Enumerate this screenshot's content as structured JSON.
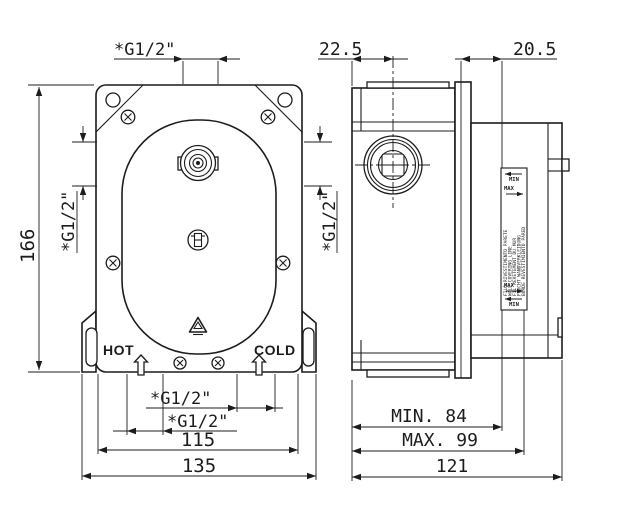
{
  "colors": {
    "line": "#1c1c1c",
    "background": "#ffffff"
  },
  "icons": {
    "hot_flow_arrow": "outline-up-arrow",
    "cold_flow_arrow": "outline-up-arrow",
    "brand_mark": "triangle",
    "fastener": "phillips-screw"
  },
  "front_view": {
    "top_port_label": "*G1/2\"",
    "left_port_label": "*G1/2\"",
    "right_port_label": "*G1/2\"",
    "height_dim": "166",
    "hot_label": "HOT",
    "cold_label": "COLD",
    "bottom_port_label_1": "*G1/2\"",
    "bottom_port_label_2": "*G1/2\"",
    "inner_width_dim": "115",
    "outer_width_dim": "135"
  },
  "side_view": {
    "top_offset_dim": "22.5",
    "plate_depth_dim": "20.5",
    "min_depth_dim": "MIN. 84",
    "max_depth_dim": "MAX. 99",
    "total_depth_dim": "121",
    "label_plate": {
      "top_min": "MIN",
      "top_max": "MAX",
      "bottom_max": "MAX",
      "bottom_min": "MIN",
      "lines": [
        "FILO RIVESTIMENTO PARETE",
        "WALL COVERING LINE",
        "FIL REVETEMENT DU MUR",
        "FLUCHT WANDVERKLEIDUNG",
        "BORDE REVESTIMIENTO PARED"
      ]
    }
  }
}
